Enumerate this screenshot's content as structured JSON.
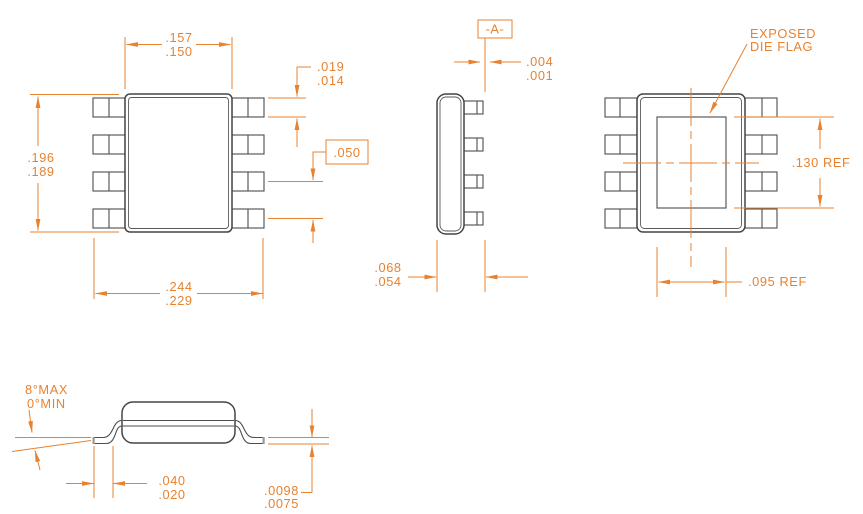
{
  "colors": {
    "dimension_accent": "#e8822f",
    "drawing_line": "#4d4d4d",
    "pin1_hatch_fill": "#f7d3ac",
    "pin1_hatch_line": "#db8b3f",
    "background": "#ffffff"
  },
  "front_view": {
    "body_width_max": ".157",
    "body_width_min": ".150",
    "body_height_max": ".196",
    "body_height_min": ".189",
    "lead_span_max": ".244",
    "lead_span_min": ".229",
    "lead_width_max": ".019",
    "lead_width_min": ".014",
    "lead_pitch": ".050"
  },
  "side_view": {
    "datum_label": "-A-",
    "standoff_max": ".004",
    "standoff_min": ".001",
    "thickness_max": ".068",
    "thickness_min": ".054"
  },
  "bottom_view": {
    "note_line1": "EXPOSED",
    "note_line2": "DIE FLAG",
    "die_flag_length": ".130  REF",
    "die_flag_width": ".095  REF"
  },
  "profile_view": {
    "lead_angle_max": "8°MAX",
    "lead_angle_min": "0°MIN",
    "foot_length_max": ".040",
    "foot_length_min": ".020",
    "lead_thickness_max": ".0098",
    "lead_thickness_min": ".0075"
  }
}
